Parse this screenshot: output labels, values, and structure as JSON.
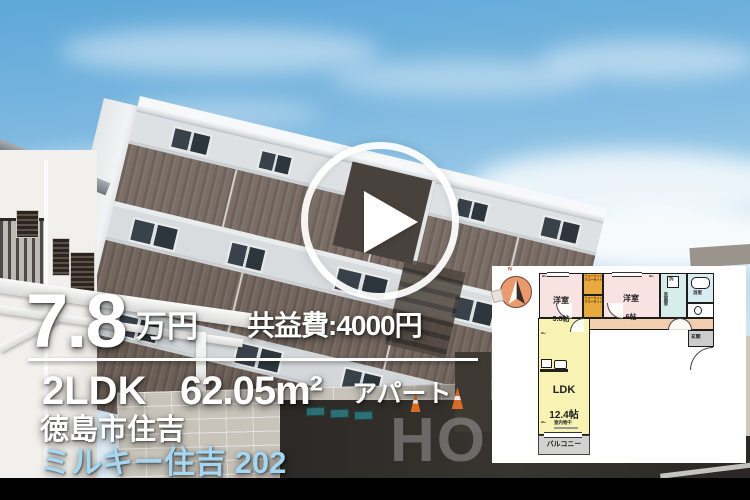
{
  "listing": {
    "price": "7.8",
    "price_unit": "万円",
    "common_fee": "共益費:4000円",
    "layout": "2LDK",
    "area": "62.05m²",
    "building_type": "アパート",
    "address": "徳島市住吉",
    "property_name": "ミルキー住吉 202"
  },
  "colors": {
    "property_name_text": "#a5d7f2",
    "overlay_text": "#ffffff",
    "closet_fill": "#e9a93e",
    "bedroom_fill": "#f8e3e2",
    "ldk_fill": "#f8f3b3",
    "corridor_fill": "#f2cfae",
    "wet_area_fill": "#d6edea"
  },
  "photo": {
    "watermark": "HO"
  },
  "floorplan": {
    "compass_n": "N",
    "bedroom1_name": "洋室",
    "bedroom1_size": "5.8帖",
    "closet": "ウォークインクローゼット",
    "bedroom2_name": "洋室",
    "bedroom2_size": "6帖",
    "washer": "洗",
    "washroom": "洗面室",
    "bathroom": "浴室",
    "entrance": "玄関",
    "ldk_name": "LDK",
    "ldk_size": "12.4帖",
    "indoor_drying": "室内物干",
    "balcony": "バルコニー",
    "ac_label": "AC"
  }
}
